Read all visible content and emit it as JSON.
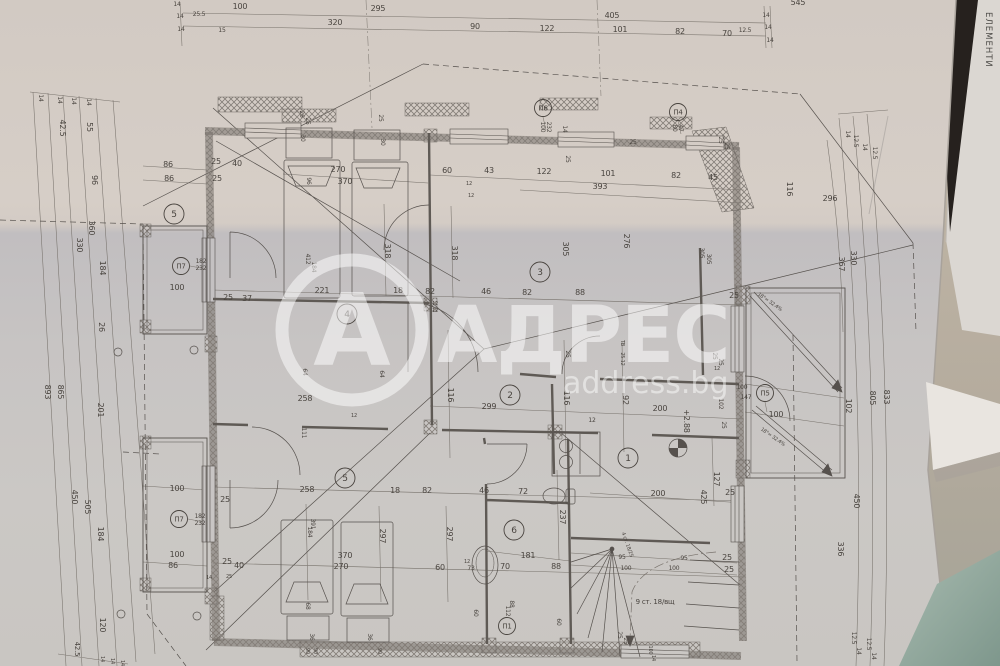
{
  "photo": {
    "watermark": {
      "logo_letter": "А",
      "brand": "АДРЕС",
      "site": "address.bg"
    },
    "side_sheet_vertical_text": "ЕЛЕМЕНТИ",
    "colors": {
      "paper_top": "#d5cdc6",
      "paper_bottom": "#c9c6c2",
      "shadow_wedge": "#26211e",
      "table_beige": "#c6bbaa",
      "table_teal": "#7e978c",
      "ink": "#56514d",
      "watermark_white": "#ffffff"
    }
  },
  "plan": {
    "room_circles": [
      [
        "1",
        628,
        458
      ],
      [
        "2",
        510,
        395
      ],
      [
        "3",
        540,
        272
      ],
      [
        "4",
        347,
        314
      ],
      [
        "5",
        174,
        214
      ],
      [
        "5",
        345,
        478
      ],
      [
        "6",
        514,
        530
      ]
    ],
    "tag_circles": [
      [
        "П6",
        543,
        108
      ],
      [
        "П4",
        678,
        112
      ],
      [
        "П5",
        765,
        393
      ],
      [
        "П7",
        181,
        266
      ],
      [
        "П7",
        179,
        519
      ],
      [
        "П1",
        507,
        626
      ]
    ],
    "labels": [
      [
        "545",
        798,
        5
      ],
      [
        "100",
        240,
        9
      ],
      [
        "295",
        378,
        11
      ],
      [
        "405",
        612,
        18
      ],
      [
        "320",
        335,
        25
      ],
      [
        "90",
        475,
        29
      ],
      [
        "122",
        547,
        31
      ],
      [
        "101",
        620,
        32
      ],
      [
        "82",
        680,
        34
      ],
      [
        "70",
        727,
        36
      ],
      [
        "12.5",
        745,
        32,
        0,
        6
      ],
      [
        "14",
        766,
        17,
        0,
        6
      ],
      [
        "14",
        768,
        29,
        0,
        6
      ],
      [
        "14",
        770,
        42,
        0,
        6
      ],
      [
        "14",
        177,
        6,
        0,
        6
      ],
      [
        "14",
        180,
        18,
        0,
        6
      ],
      [
        "25.5",
        199,
        16,
        0,
        6
      ],
      [
        "14",
        181,
        31,
        0,
        6
      ],
      [
        "15",
        222,
        32,
        0,
        6
      ],
      [
        "14",
        39,
        98,
        90,
        6
      ],
      [
        "14",
        58,
        100,
        90,
        6
      ],
      [
        "14",
        72,
        101,
        90,
        6
      ],
      [
        "14",
        87,
        102,
        90,
        6
      ],
      [
        "42.5",
        60,
        128,
        90
      ],
      [
        "55",
        87,
        127,
        90
      ],
      [
        "96",
        92,
        180,
        90
      ],
      [
        "360",
        89,
        228,
        90
      ],
      [
        "330",
        77,
        245,
        90
      ],
      [
        "184",
        100,
        268,
        90
      ],
      [
        "26",
        99,
        327,
        90
      ],
      [
        "893",
        45,
        392,
        90
      ],
      [
        "865",
        58,
        392,
        90
      ],
      [
        "201",
        98,
        410,
        90
      ],
      [
        "450",
        72,
        497,
        90
      ],
      [
        "505",
        85,
        507,
        90
      ],
      [
        "184",
        98,
        534,
        90
      ],
      [
        "120",
        100,
        625,
        90
      ],
      [
        "42.5",
        75,
        649,
        90,
        7
      ],
      [
        "14",
        101,
        659,
        90,
        5
      ],
      [
        "14",
        111,
        661,
        90,
        5
      ],
      [
        "14",
        121,
        663,
        90,
        5
      ],
      [
        "14",
        846,
        134,
        90,
        6
      ],
      [
        "12.5",
        854,
        141,
        90,
        6
      ],
      [
        "14",
        863,
        147,
        90,
        6
      ],
      [
        "12.5",
        873,
        153,
        90,
        6
      ],
      [
        "330",
        851,
        258,
        90
      ],
      [
        "367",
        839,
        264,
        90
      ],
      [
        "102",
        846,
        406,
        90
      ],
      [
        "805",
        870,
        398,
        90
      ],
      [
        "833",
        884,
        397,
        90
      ],
      [
        "450",
        854,
        501,
        90
      ],
      [
        "336",
        838,
        549,
        90
      ],
      [
        "12.5",
        852,
        638,
        90,
        6
      ],
      [
        "14",
        857,
        651,
        90,
        6
      ],
      [
        "12.5",
        867,
        644,
        90,
        6
      ],
      [
        "14",
        872,
        656,
        90,
        6
      ],
      [
        "86",
        168,
        167
      ],
      [
        "25",
        216,
        164
      ],
      [
        "40",
        237,
        166
      ],
      [
        "86",
        169,
        181
      ],
      [
        "25",
        217,
        181
      ],
      [
        "26",
        300,
        114,
        90,
        6
      ],
      [
        "25",
        306,
        121,
        90,
        6
      ],
      [
        "25",
        379,
        118,
        90,
        6
      ],
      [
        "30",
        301,
        138,
        90,
        6
      ],
      [
        "30",
        381,
        142,
        90,
        6
      ],
      [
        "96",
        307,
        181,
        90,
        6
      ],
      [
        "270",
        338,
        172
      ],
      [
        "370",
        345,
        184
      ],
      [
        "318",
        385,
        251,
        90
      ],
      [
        "318",
        452,
        253,
        90
      ],
      [
        "412",
        306,
        259,
        90,
        6
      ],
      [
        "184",
        312,
        267,
        90,
        6
      ],
      [
        "100",
        177,
        290
      ],
      [
        "25",
        228,
        300
      ],
      [
        "37",
        247,
        301
      ],
      [
        "182",
        201,
        263,
        0,
        6
      ],
      [
        "232",
        201,
        270,
        0,
        6
      ],
      [
        "64",
        303,
        372,
        90,
        6
      ],
      [
        "64",
        380,
        374,
        90,
        6
      ],
      [
        "258",
        305,
        401
      ],
      [
        "111",
        302,
        433,
        90,
        6
      ],
      [
        "12",
        354,
        417,
        0,
        5
      ],
      [
        "60",
        447,
        173
      ],
      [
        "43",
        489,
        173
      ],
      [
        "122",
        544,
        174
      ],
      [
        "101",
        608,
        176
      ],
      [
        "82",
        676,
        178
      ],
      [
        "45",
        713,
        180
      ],
      [
        "393",
        600,
        189
      ],
      [
        "12",
        469,
        185,
        0,
        5
      ],
      [
        "12",
        471,
        197,
        0,
        5
      ],
      [
        "100",
        541,
        127,
        90,
        6
      ],
      [
        "232",
        547,
        127,
        90,
        6
      ],
      [
        "14",
        563,
        129,
        90,
        6
      ],
      [
        "25",
        566,
        159,
        90,
        6
      ],
      [
        "80",
        673,
        128,
        90,
        6
      ],
      [
        "47",
        679,
        128,
        90,
        6
      ],
      [
        "25",
        633,
        144,
        0,
        6
      ],
      [
        "25",
        719,
        140,
        90,
        6
      ],
      [
        "25",
        725,
        146,
        90,
        6
      ],
      [
        "305",
        563,
        249,
        90
      ],
      [
        "276",
        624,
        241,
        90
      ],
      [
        "305",
        700,
        253,
        90,
        6
      ],
      [
        "305",
        707,
        259,
        90,
        6
      ],
      [
        "116",
        787,
        189,
        90
      ],
      [
        "296",
        830,
        201
      ],
      [
        "25",
        734,
        298
      ],
      [
        "25",
        713,
        356,
        90,
        6
      ],
      [
        "25",
        719,
        362,
        90,
        6
      ],
      [
        "12",
        717,
        370,
        0,
        5
      ],
      [
        "221",
        322,
        293
      ],
      [
        "18",
        398,
        293
      ],
      [
        "82",
        430,
        294
      ],
      [
        "12",
        435,
        305,
        0,
        5
      ],
      [
        "12",
        435,
        312,
        0,
        5
      ],
      [
        "46",
        486,
        294
      ],
      [
        "82",
        527,
        295
      ],
      [
        "88",
        580,
        295
      ],
      [
        "116",
        448,
        395,
        90
      ],
      [
        "299",
        489,
        409
      ],
      [
        "116",
        564,
        398,
        90
      ],
      [
        "92",
        623,
        400,
        90
      ],
      [
        "200",
        660,
        411
      ],
      [
        "12",
        592,
        422,
        0,
        6
      ],
      [
        "ТВ",
        621,
        343,
        90,
        5
      ],
      [
        "25.12",
        621,
        359,
        90,
        5
      ],
      [
        "25",
        566,
        354,
        90,
        6
      ],
      [
        "+2.88",
        684,
        421,
        90
      ],
      [
        "200",
        658,
        496
      ],
      [
        "127",
        714,
        479,
        90
      ],
      [
        "425",
        701,
        497,
        90
      ],
      [
        "25",
        730,
        495
      ],
      [
        "100",
        742,
        389,
        0,
        6
      ],
      [
        "147",
        746,
        399,
        0,
        6
      ],
      [
        "100",
        776,
        417
      ],
      [
        "102",
        719,
        404,
        90,
        6
      ],
      [
        "25",
        722,
        425,
        90,
        6
      ],
      [
        "18°= 32.4%",
        769,
        303,
        35,
        5
      ],
      [
        "18°= 32.4%",
        772,
        438,
        35,
        5
      ],
      [
        "258",
        307,
        492
      ],
      [
        "18",
        395,
        493
      ],
      [
        "82",
        427,
        493
      ],
      [
        "46",
        484,
        493
      ],
      [
        "72",
        523,
        494
      ],
      [
        "391",
        311,
        524,
        90,
        6
      ],
      [
        "184",
        308,
        532,
        90,
        6
      ],
      [
        "297",
        380,
        536,
        90
      ],
      [
        "297",
        447,
        534,
        90
      ],
      [
        "370",
        345,
        558
      ],
      [
        "270",
        341,
        569
      ],
      [
        "60",
        440,
        570
      ],
      [
        "12",
        467,
        563,
        0,
        5
      ],
      [
        "73",
        471,
        570,
        0,
        6
      ],
      [
        "70",
        505,
        569
      ],
      [
        "88",
        556,
        569
      ],
      [
        "237",
        560,
        517,
        90
      ],
      [
        "181",
        528,
        558
      ],
      [
        "68",
        306,
        606,
        90,
        6
      ],
      [
        "36",
        310,
        637,
        90,
        6
      ],
      [
        "36",
        368,
        637,
        90,
        6
      ],
      [
        "90",
        306,
        651,
        90,
        5
      ],
      [
        "90",
        314,
        651,
        90,
        5
      ],
      [
        "90",
        378,
        651,
        90,
        5
      ],
      [
        "100",
        177,
        491
      ],
      [
        "25",
        225,
        502
      ],
      [
        "182",
        200,
        518,
        0,
        6
      ],
      [
        "232",
        200,
        525,
        0,
        6
      ],
      [
        "100",
        177,
        557
      ],
      [
        "86",
        173,
        568
      ],
      [
        "25",
        227,
        564
      ],
      [
        "40",
        239,
        568
      ],
      [
        "14",
        209,
        579,
        0,
        5
      ],
      [
        "25",
        229,
        578,
        0,
        5
      ],
      [
        "95",
        622,
        559,
        0,
        6
      ],
      [
        "95",
        684,
        560,
        0,
        6
      ],
      [
        "100",
        626,
        570,
        0,
        6
      ],
      [
        "100",
        674,
        570,
        0,
        6
      ],
      [
        "25",
        727,
        560
      ],
      [
        "25",
        729,
        572
      ],
      [
        "9 ст. 18/вщ",
        655,
        604,
        0,
        7
      ],
      [
        "4 ст. 18/25",
        626,
        545,
        70,
        5
      ],
      [
        "88",
        510,
        604,
        90,
        6
      ],
      [
        "112",
        506,
        611,
        90,
        6
      ],
      [
        "60",
        557,
        622,
        90,
        6
      ],
      [
        "60",
        474,
        613,
        90,
        6
      ],
      [
        "25",
        618,
        635,
        90,
        6
      ],
      [
        "25",
        624,
        641,
        90,
        6
      ],
      [
        "100",
        649,
        650,
        90,
        5
      ],
      [
        "14",
        652,
        658,
        90,
        5
      ]
    ]
  }
}
